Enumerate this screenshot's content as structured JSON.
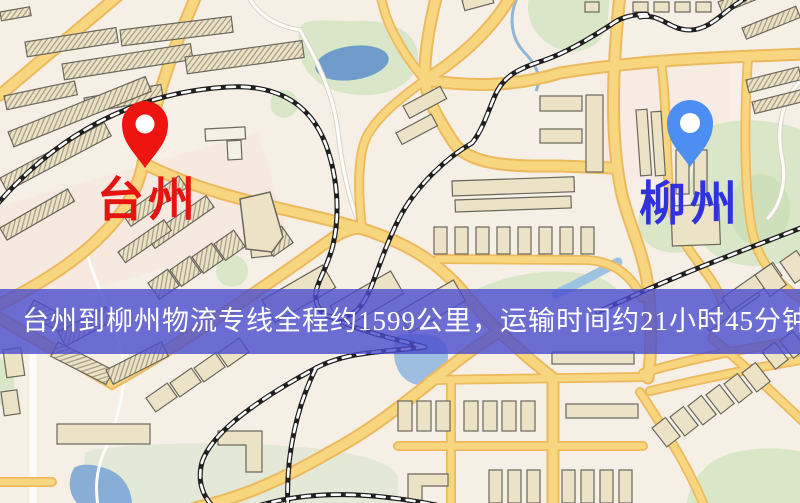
{
  "banner": {
    "text": "台州到柳州物流专线全程约1599公里，运输时间约21小时45分钟."
  },
  "markers": {
    "origin": {
      "label": "台州",
      "pin_color": "#ee1510",
      "pin_inner_color": "#ffffff",
      "label_color": "#e61310"
    },
    "destination": {
      "label": "柳州",
      "pin_color": "#4d8ef2",
      "pin_inner_color": "#ffffff",
      "label_color": "#3032dd"
    }
  },
  "palette": {
    "map_bg": "#f6efe6",
    "road_fill": "#f8d680",
    "road_casing": "#ecb95c",
    "minor_road": "#fdfcf8",
    "building_fill": "#ece3c7",
    "building_stroke": "#6a675c",
    "green_area": "#d9e7c8",
    "green_field": "#e3e9d6",
    "water": "#6f9ccb",
    "railway": "#1f1f1f",
    "banner_bg": "#4a4cce",
    "banner_text": "#ffffff"
  }
}
